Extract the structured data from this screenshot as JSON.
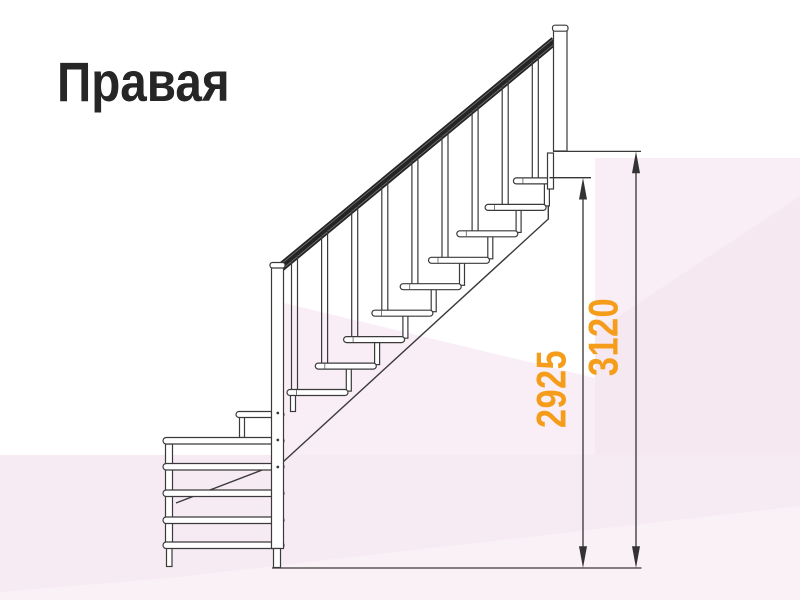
{
  "title": "Правая",
  "dimensions": [
    {
      "id": "height-to-top-step",
      "value": "2925"
    },
    {
      "id": "height-to-floor-level",
      "value": "3120"
    }
  ],
  "colors": {
    "accent_orange": "#F59D1A",
    "line": "#3A3A3A",
    "handrail": "#242424",
    "background_pink": "#F8ECF4",
    "title_text": "#262626"
  }
}
